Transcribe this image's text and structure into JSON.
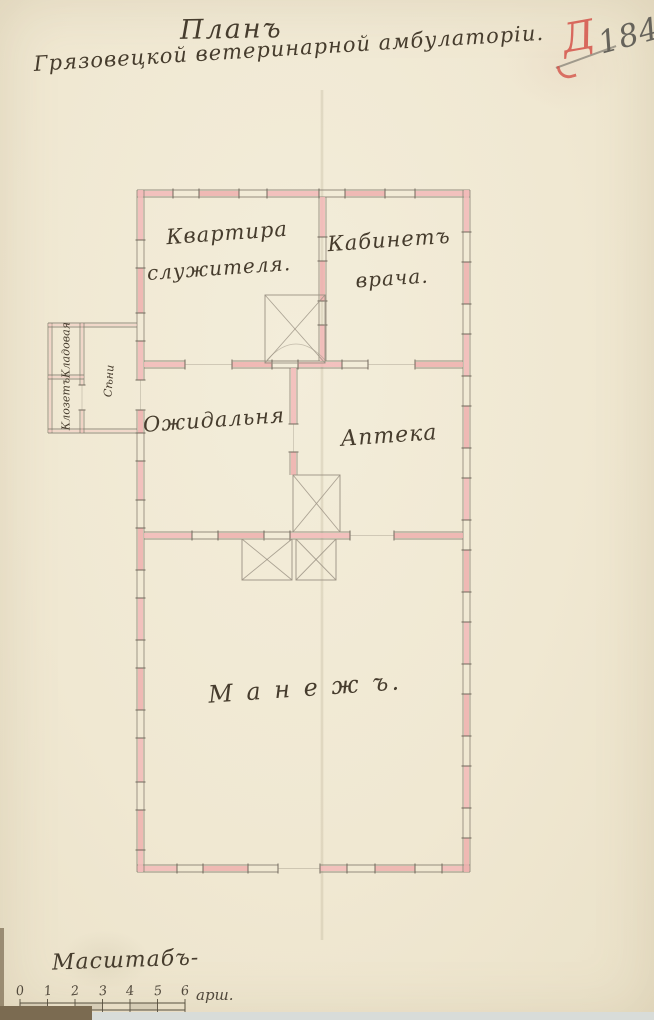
{
  "page": {
    "number": "184",
    "red_mark": "Д"
  },
  "title": {
    "line1": "Планъ",
    "line2": "Грязовецкой ветеринарной амбулаторіи."
  },
  "rooms": {
    "kvartira_1": "Квартира",
    "kvartira_2": "служителя.",
    "kabinet_1": "Кабинетъ",
    "kabinet_2": "врача.",
    "ozhidalnya": "Ожидальня",
    "apteka": "Аптека",
    "manezh": "М а н е ж ъ.",
    "kladovaya": "Кладовая",
    "klozet": "Клозетъ",
    "seni": "Сѣни"
  },
  "scale": {
    "label": "Масштабъ-",
    "ticks": [
      "0",
      "1",
      "2",
      "3",
      "4",
      "5",
      "6"
    ],
    "unit": "арш."
  },
  "colors": {
    "paper": "#f1ead5",
    "wall_pink": "#f2bab8",
    "wall_line": "#8c8375",
    "ink": "#463c2d",
    "red_mark": "#d5544a",
    "pencil": "#66635b"
  }
}
